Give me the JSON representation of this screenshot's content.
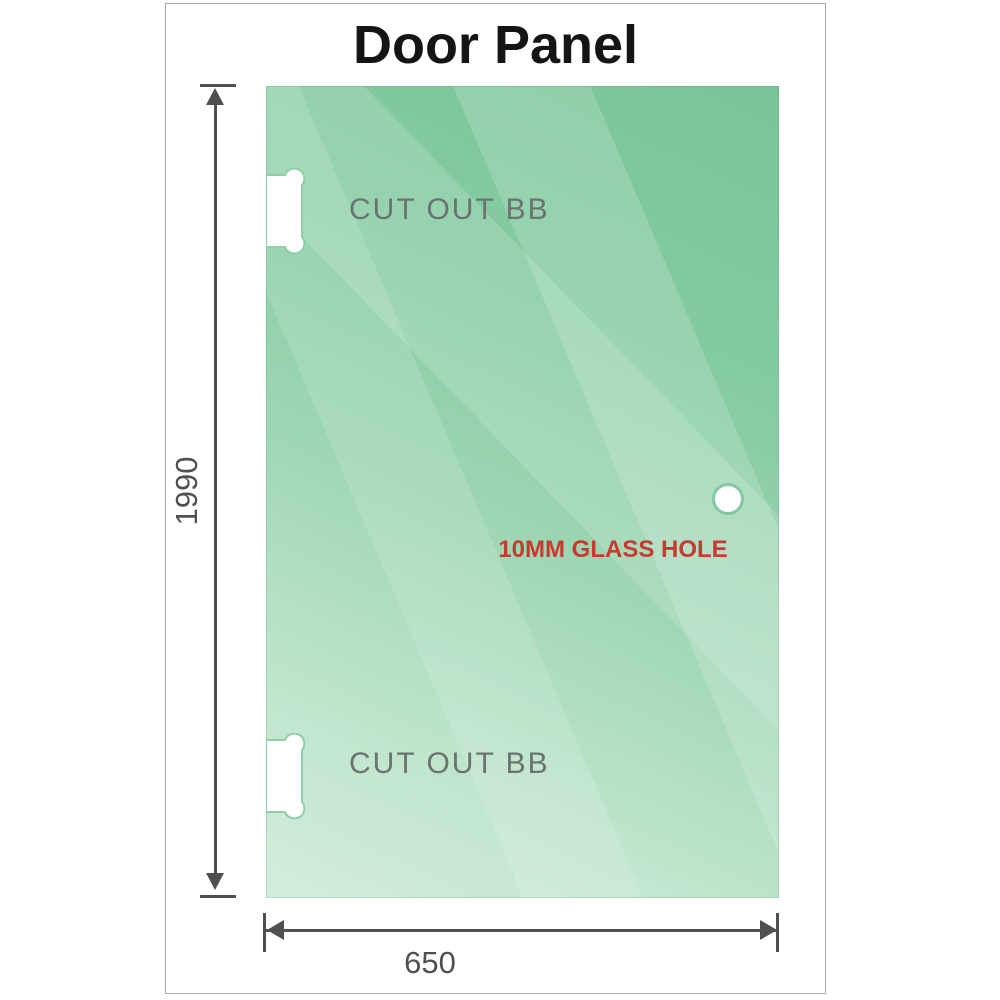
{
  "title": "Door Panel",
  "panel": {
    "cutouts": [
      {
        "label": "CUT OUT BB"
      },
      {
        "label": "CUT OUT BB"
      }
    ],
    "hole": {
      "label": "10MM GLASS HOLE"
    }
  },
  "dimensions": {
    "height": {
      "value": "1990"
    },
    "width": {
      "value": "650"
    }
  },
  "colors": {
    "glass-dark": "#79c497",
    "glass-mid": "#9fd6b4",
    "glass-light": "#d3eddc",
    "glass-rim": "#84c6a1",
    "dim-gray": "#4f4f4f",
    "text-gray": "#6b7370",
    "label-red": "#c63a30",
    "frame-border": "#a8a8a8",
    "title-color": "#151515"
  }
}
